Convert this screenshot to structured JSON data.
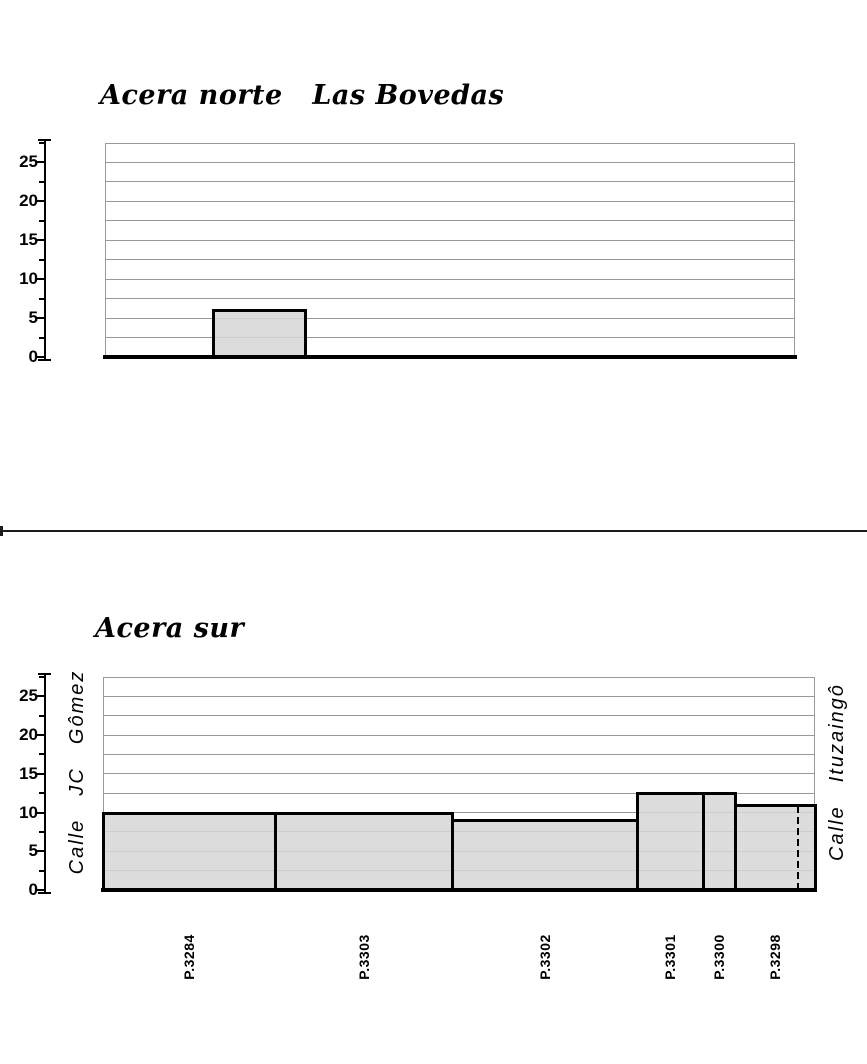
{
  "chart_data": [
    {
      "type": "bar",
      "title": "Acera norte   Las Bovedas",
      "xlabel": "",
      "ylabel": "",
      "ylim": [
        0,
        27.5
      ],
      "yticks": [
        0,
        5,
        10,
        15,
        20,
        25
      ],
      "minor_gridline_step": 2.5,
      "grid": "horizontal",
      "legend": "none",
      "categories": [
        ""
      ],
      "values": [
        6
      ],
      "notes": "Single gray building block (~6 m high) left of center on an otherwise empty frontage; thick black ground line."
    },
    {
      "type": "bar",
      "title": "Acera sur",
      "left_axis_label": "Calle  JC  Gômez",
      "right_axis_label": "Calle  Ituzaingô",
      "ylim": [
        0,
        27.5
      ],
      "yticks": [
        0,
        5,
        10,
        15,
        20,
        25
      ],
      "minor_gridline_step": 2.5,
      "grid": "horizontal",
      "legend": "none",
      "categories": [
        "P.3284",
        "P.3303",
        "P.3302",
        "P.3301",
        "P.3300",
        "P.3298"
      ],
      "values": [
        10,
        10,
        9,
        12.5,
        12.5,
        11
      ],
      "notes": "Contiguous building profile spanning the whole block between both streets; dashed property line inside parcel P.3298 near right edge."
    }
  ],
  "charts": [
    {
      "title": "Acera norte   Las Bovedas",
      "y_ticks": [
        0,
        5,
        10,
        15,
        20,
        25
      ],
      "y_max": 27.5,
      "minor_step": 2.5,
      "segments": [
        {
          "label": "",
          "height": 6,
          "x0": 108,
          "x1": 200
        }
      ],
      "dashed_lines": []
    },
    {
      "title": "Acera sur",
      "left_street": "Calle  JC  Gômez",
      "right_street": "Calle  Ituzaingô",
      "y_ticks": [
        0,
        5,
        10,
        15,
        20,
        25
      ],
      "y_max": 27.5,
      "minor_step": 2.5,
      "segments": [
        {
          "label": "P.3284",
          "height": 10,
          "x0": 0,
          "x1": 172
        },
        {
          "label": "P.3303",
          "height": 10,
          "x0": 172,
          "x1": 349
        },
        {
          "label": "P.3302",
          "height": 9,
          "x0": 349,
          "x1": 534
        },
        {
          "label": "P.3301",
          "height": 12.5,
          "x0": 534,
          "x1": 600
        },
        {
          "label": "P.3300",
          "height": 12.5,
          "x0": 600,
          "x1": 632
        },
        {
          "label": "P.3298",
          "height": 11,
          "x0": 632,
          "x1": 712
        }
      ],
      "dashed_lines": [
        {
          "x": 695,
          "height": 11
        }
      ]
    }
  ],
  "colors": {
    "background": "#ffffff",
    "gridline": "#999999",
    "frame": "#999999",
    "bar_fill": "#dedede",
    "outline": "#000000"
  }
}
